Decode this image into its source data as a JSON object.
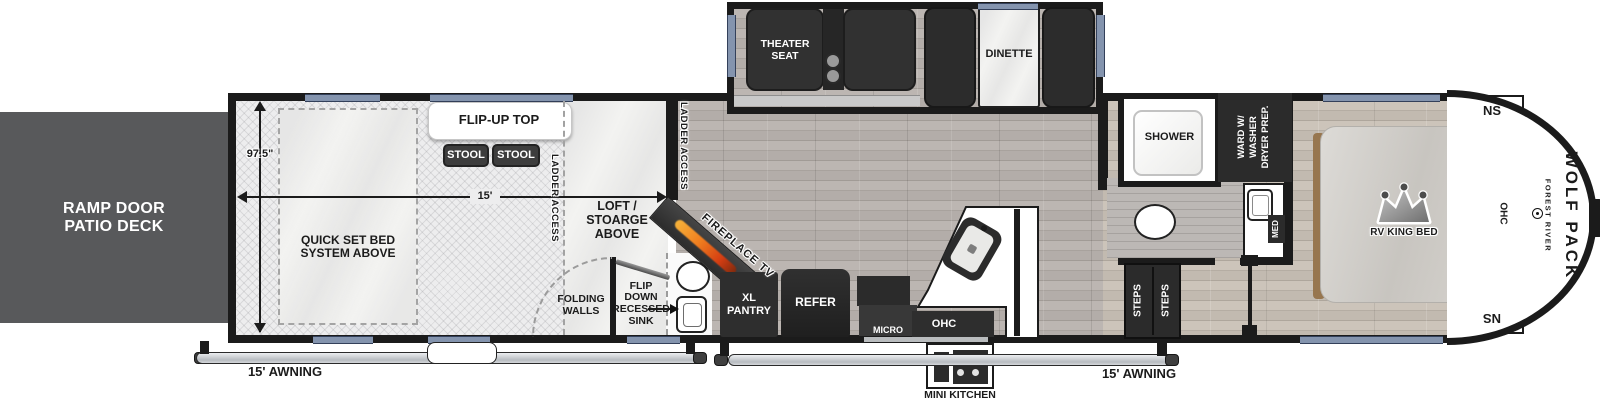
{
  "colors": {
    "wall": "#1b1b1b",
    "deck": "#58595b",
    "furniture_dark": "#2e2e2e",
    "window_blue": "#8494ae",
    "flame_orange": "#e8731f"
  },
  "garage": {
    "ramp_deck": "RAMP DOOR\nPATIO DECK",
    "width_dim": "97.5\"",
    "length_dim": "15'",
    "flip_up_top": "FLIP-UP TOP",
    "stool1": "STOOL",
    "stool2": "STOOL",
    "quick_set_bed": "QUICK SET BED\nSYSTEM ABOVE",
    "ladder_access": "LADDER ACCESS",
    "loft_storage": "LOFT / STOARGE\nABOVE",
    "folding_walls": "FOLDING\nWALLS",
    "flip_down_sink": "FLIP\nDOWN\nRECESSED\nSINK"
  },
  "living": {
    "ladder_access": "LADDER ACCESS",
    "fireplace": "FIREPLACE TV",
    "xl_pantry": "XL\nPANTRY",
    "refer": "REFER",
    "micro": "MICRO",
    "ohc": "OHC",
    "mini_kitchen": "MINI KITCHEN",
    "theater_seat": "THEATER\nSEAT",
    "dinette": "DINETTE"
  },
  "bath": {
    "shower": "SHOWER",
    "ward": "WARD W/\nWASHER\nDRYER PREP.",
    "med": "MED",
    "steps1": "STEPS",
    "steps2": "STEPS"
  },
  "bedroom": {
    "bed": "RV KING BED",
    "ohc": "OHC",
    "ns_top": "NS",
    "ns_bottom": "NS"
  },
  "exterior": {
    "awning_left": "15' AWNING",
    "awning_right": "15' AWNING",
    "brand_line1": "FOREST RIVER",
    "brand_line2": "WOLF PACK"
  }
}
